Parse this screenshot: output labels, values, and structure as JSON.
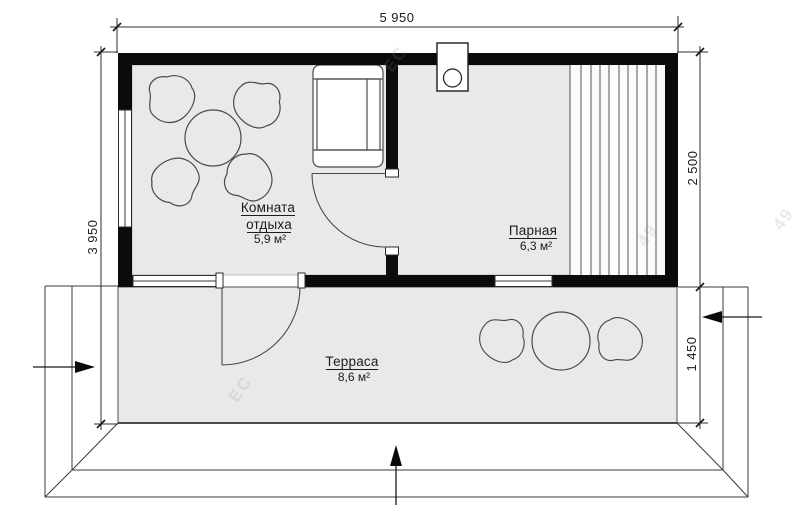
{
  "plan": {
    "dimensions": {
      "total_width": "5 950",
      "total_depth": "3 950",
      "main_depth": "2 500",
      "terrace_depth": "1 450"
    },
    "rooms": {
      "rest": {
        "name_line1": "Комната",
        "name_line2": "отдыха",
        "area": "5,9 м²"
      },
      "steam": {
        "name": "Парная",
        "area": "6,3 м²"
      },
      "terrace": {
        "name": "Терраса",
        "area": "8,6 м²"
      }
    },
    "colors": {
      "wall": "#0b0b0b",
      "floor": "#e9e9e9",
      "line": "#3a3a3a"
    },
    "watermark": {
      "frag1": "ЕС",
      "frag2": "49",
      "frag3": "ЕС",
      "frag4": "49"
    }
  }
}
